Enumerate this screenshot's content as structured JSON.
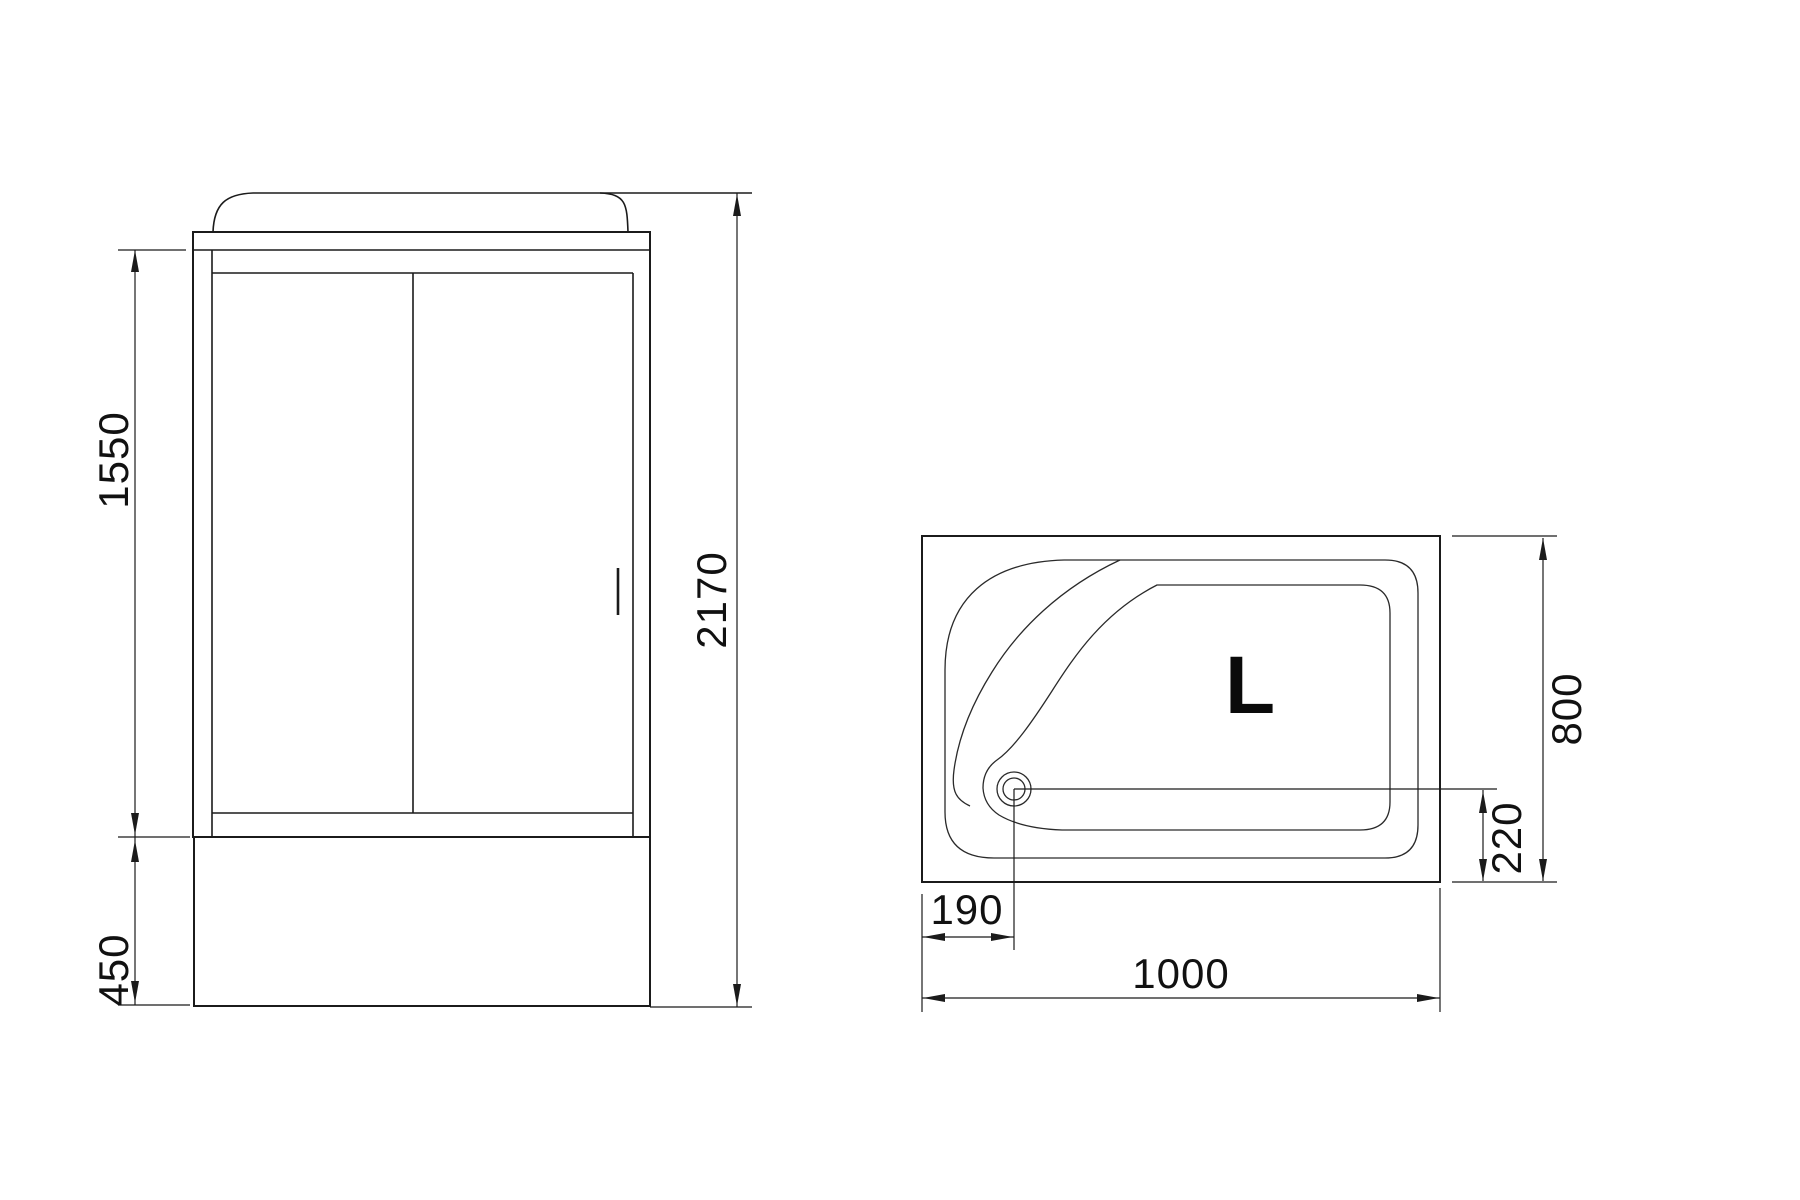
{
  "drawing": {
    "front_view": {
      "height_door_opening": "1550",
      "height_base_tray": "450",
      "height_total": "2170"
    },
    "top_view": {
      "depth": "800",
      "drain_offset_front": "220",
      "drain_offset_side": "190",
      "width": "1000",
      "orientation_label": "L"
    }
  },
  "colors": {
    "line": "#1b1b1b",
    "background": "#ffffff",
    "text": "#111111"
  }
}
